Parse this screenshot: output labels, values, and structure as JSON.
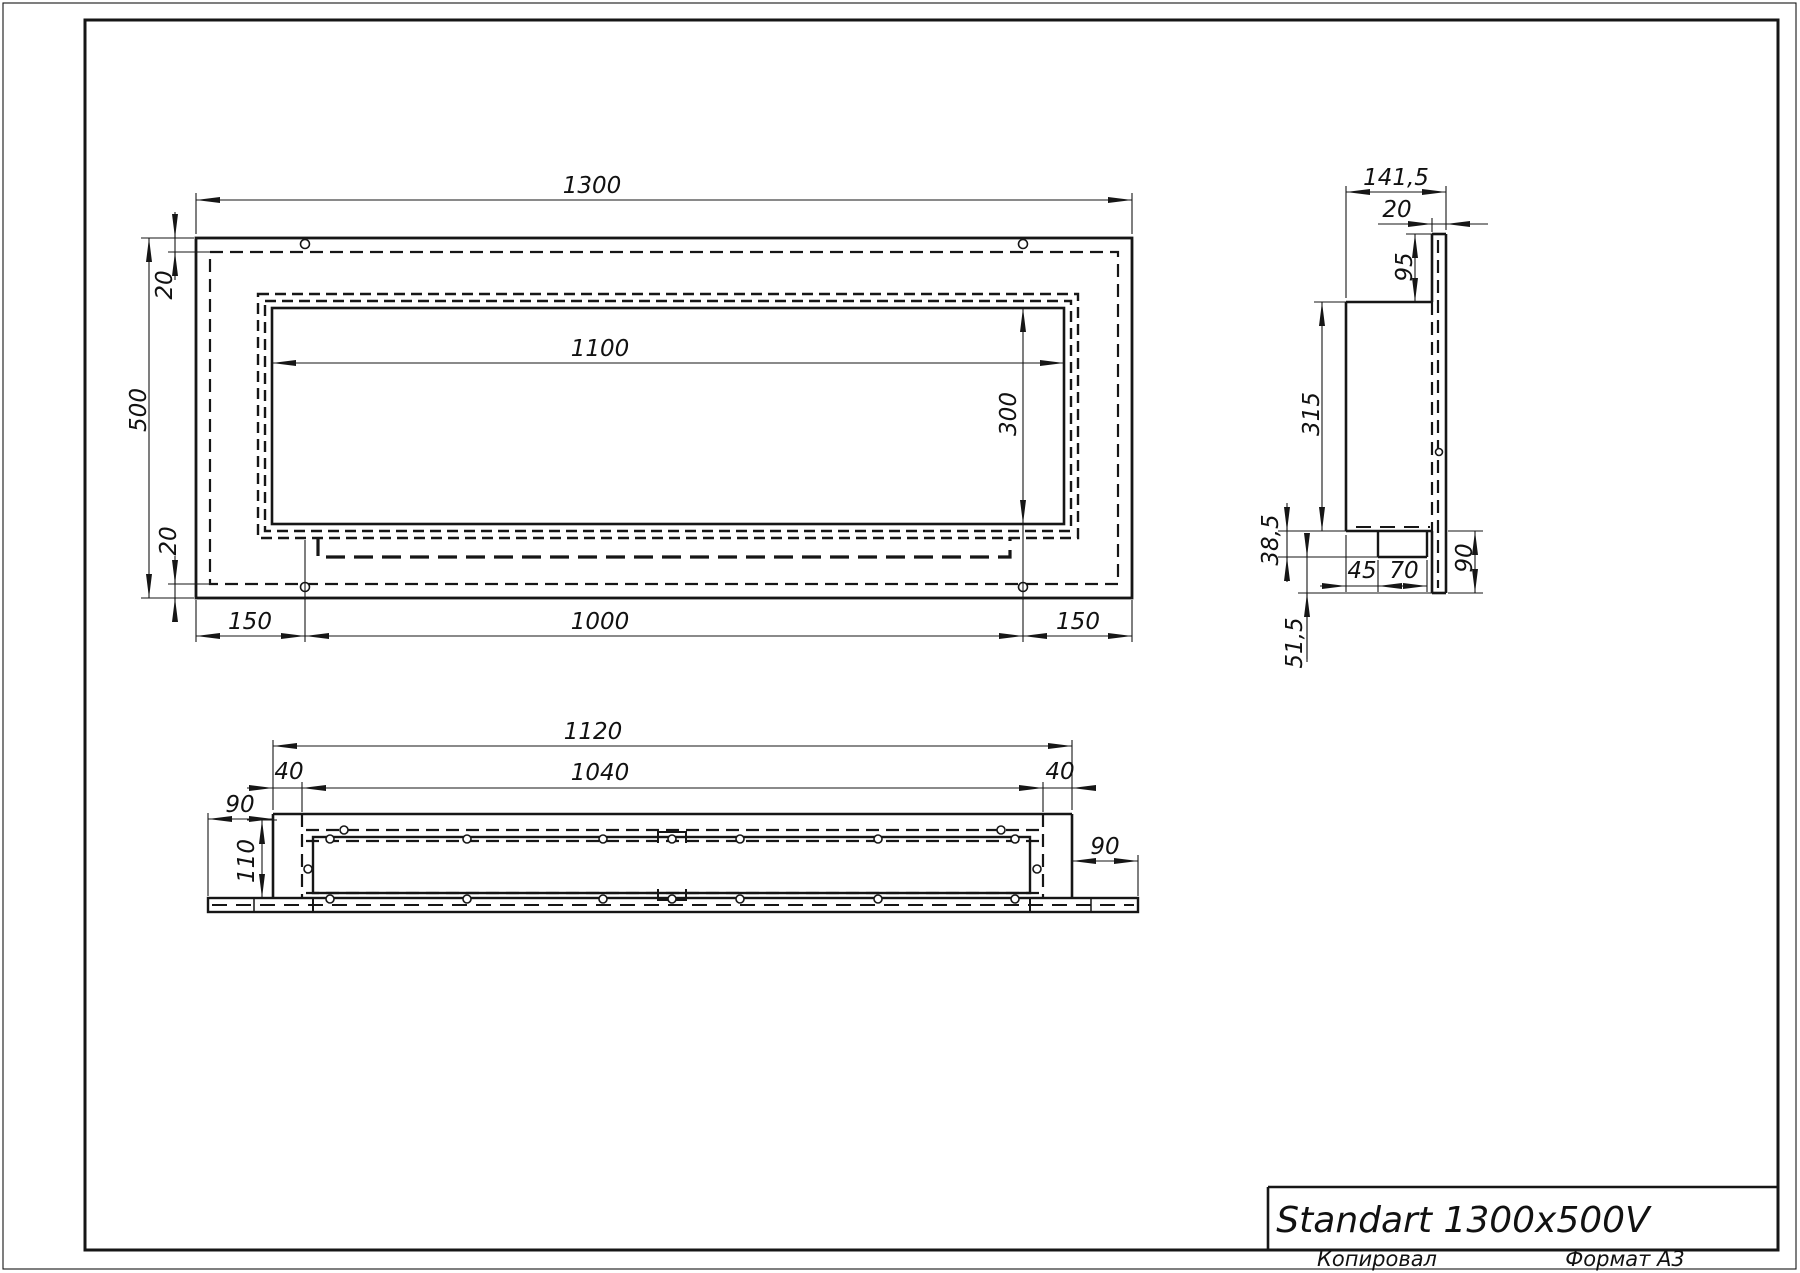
{
  "sheet": {
    "title": "Standart 1300x500V",
    "copied_label": "Копировал",
    "format_label": "Формат A3",
    "line_color": "#161616",
    "background": "#ffffff"
  },
  "front_view": {
    "dims": {
      "total_width": "1300",
      "total_height": "500",
      "inset_top": "20",
      "inset_bottom": "20",
      "opening_width": "1100",
      "opening_height": "300",
      "margin_left": "150",
      "holes_span": "1000",
      "margin_right": "150"
    }
  },
  "side_view": {
    "dims": {
      "total_depth": "141,5",
      "panel_thickness": "20",
      "top_offset": "95",
      "body_height": "315",
      "tray_drop": "38,5",
      "below_tray": "51,5",
      "tray_inset": "45",
      "tray_width": "70",
      "bottom_overhang": "90"
    }
  },
  "plan_view": {
    "dims": {
      "box_length": "1120",
      "inner_length": "1040",
      "inset_left": "40",
      "inset_right": "40",
      "overhang_left": "90",
      "overhang_right": "90",
      "depth": "110"
    }
  }
}
